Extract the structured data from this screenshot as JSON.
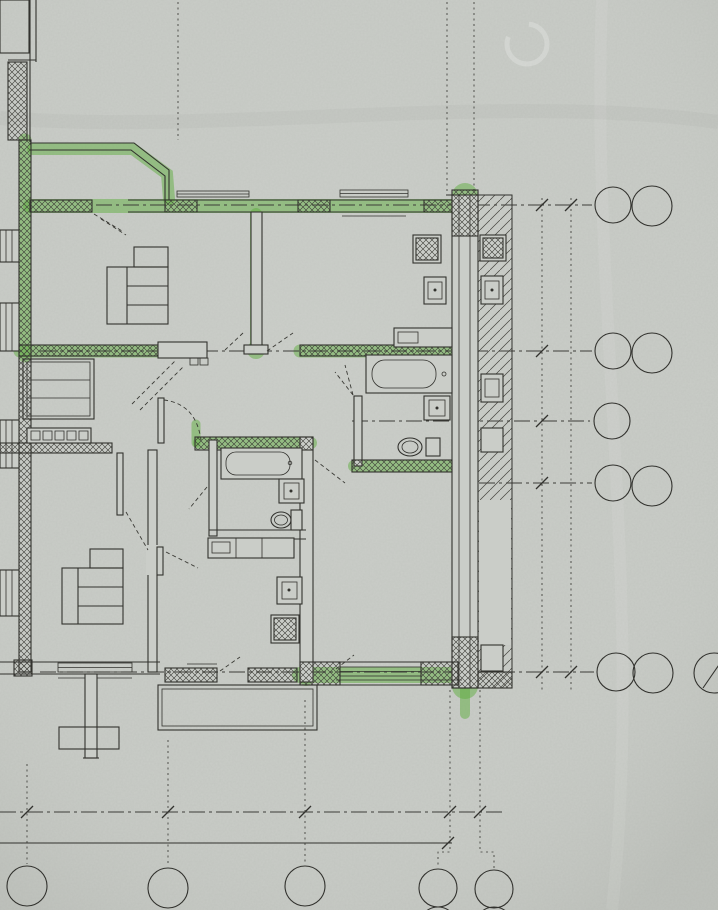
{
  "watermark": {
    "brand": "ONREALT"
  },
  "plan": {
    "block_label": "Блок-секция 2",
    "elevation_mark": "-0,200",
    "summary_table": {
      "rows": [
        "100,20",
        "192,50",
        "201,88"
      ]
    },
    "apartment_272": {
      "stamp": {
        "number": "272",
        "rooms": "2",
        "areas": [
          "28,4",
          "51,9",
          "53,5"
        ]
      },
      "living": {
        "name": "Гостиная",
        "area": "15,1"
      },
      "kitchen": {
        "name": "Кухня",
        "area": "12,3"
      },
      "bedroom": {
        "name": "Спальня",
        "area": "13,3"
      },
      "hall_area": "7,2",
      "bathroom_area": "4,0",
      "balcony_formula": "1,6=3,2×0,5"
    },
    "apartment_273": {
      "stamp": {
        "number": "273",
        "rooms": "1",
        "areas": [
          "13,10",
          "29,00",
          "30,00"
        ]
      },
      "living": {
        "name": "Гостиная",
        "area": "13,1"
      },
      "kitchen": {
        "name": "Кухня",
        "area": "7,7"
      },
      "hall_area": "4,5",
      "bathroom_area": "3,7",
      "balcony_formula": "1,0=3,4×0,3"
    },
    "dimensions": {
      "right_chain": [
        "3360",
        "2010",
        "690",
        "4690"
      ],
      "right_total": "10750",
      "bottom_chain": [
        "3250",
        "3150",
        "3300",
        "650"
      ]
    },
    "axes": {
      "right": [
        {
          "main": "Е",
          "sub": ""
        },
        {
          "main": "Е",
          "sub": "2"
        },
        {
          "main": "Д",
          "sub": ""
        },
        {
          "main": "Д",
          "sub": "2"
        },
        {
          "main": "Г",
          "sub": ""
        },
        {
          "main": "Б",
          "sub": ""
        },
        {
          "main": "Б",
          "sub": "2"
        },
        {
          "main": "А",
          "sub": ""
        },
        {
          "main": "А",
          "sub": "2"
        }
      ],
      "bottom": [
        {
          "main": "10",
          "sub": ""
        },
        {
          "main": "12",
          "sub": ""
        },
        {
          "main": "14",
          "sub": ""
        },
        {
          "main": "16",
          "sub": ""
        },
        {
          "main": "1",
          "sub": "2"
        }
      ]
    }
  }
}
